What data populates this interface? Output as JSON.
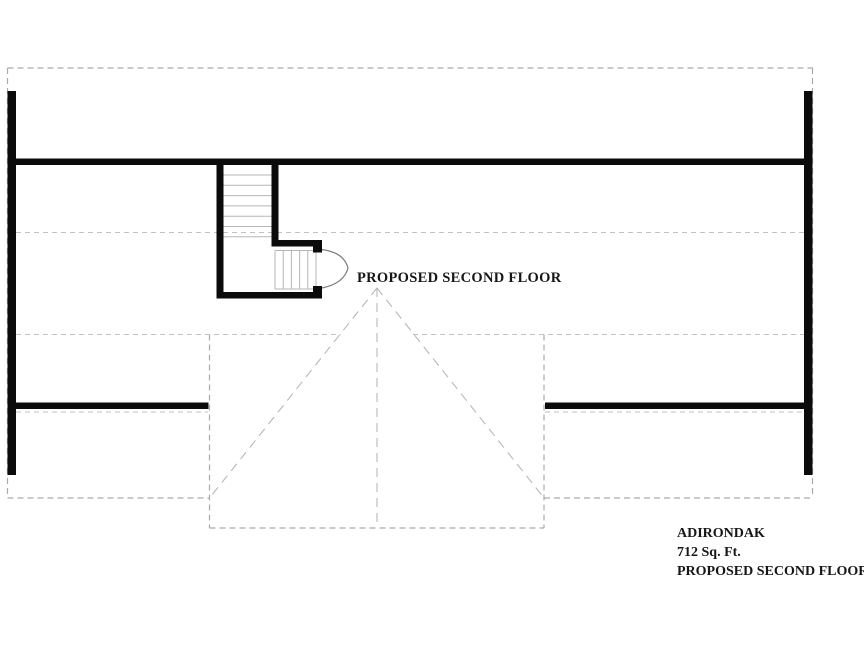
{
  "plan": {
    "label": "PROPOSED SECOND FLOOR"
  },
  "title_block": {
    "project": "ADIRONDAK",
    "area": "712 Sq. Ft.",
    "floor": "PROPOSED SECOND FLOOR"
  },
  "colors": {
    "background": "#ffffff",
    "wall": "#0b0b0b",
    "dash_outline": "#ababab",
    "dash_interior": "#c2c2c2",
    "dash_ridge": "#b8b8b8",
    "tread": "#b5b5b5",
    "door_arc": "#7a7a7a",
    "text": "#161616"
  }
}
